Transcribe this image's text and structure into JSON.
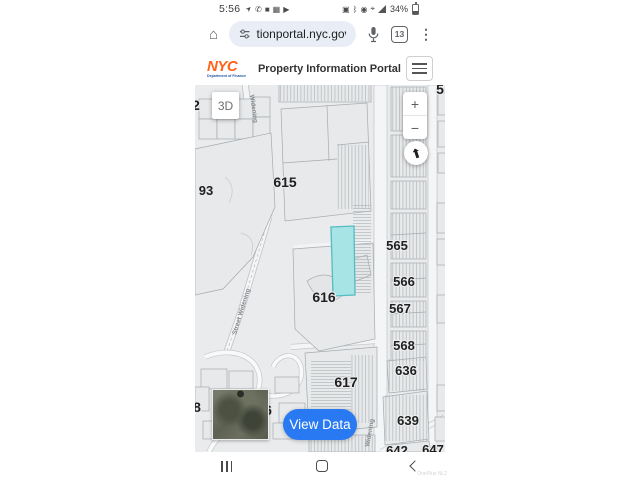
{
  "status_bar": {
    "time": "5:56",
    "battery_percent": "34%",
    "left_icons": [
      "navigation-icon",
      "whatsapp-icon",
      "app-icon",
      "app-icon-2",
      "youtube-icon"
    ],
    "right_icons": [
      "screenshot-icon",
      "bluetooth-icon",
      "location-icon",
      "vibrate-icon",
      "signal-icon",
      "battery-icon"
    ]
  },
  "browser": {
    "url": "tionportal.nyc.gov",
    "tab_count": "13",
    "menu_glyph": "⋮"
  },
  "header": {
    "logo_line1": "NYC",
    "logo_line2": "Department of Finance",
    "title": "Property Information Portal"
  },
  "map": {
    "controls": {
      "three_d": "3D",
      "zoom_in": "+",
      "zoom_out": "−",
      "view_data": "View Data"
    },
    "block_numbers": [
      "615",
      "616",
      "617",
      "565",
      "566",
      "567",
      "568",
      "636",
      "639",
      "93",
      "642",
      "647"
    ],
    "partial_numbers": [
      "2",
      "8",
      "6",
      "5"
    ],
    "street_labels": [
      "Widening",
      "Street Widening",
      "Widening"
    ],
    "colors": {
      "selected_lot_fill": "#a7e4e6",
      "selected_lot_stroke": "#54bcc2",
      "view_data_blue": "#2979f2",
      "map_background": "#e9ebec",
      "nyc_logo_orange": "#ff6319",
      "nyc_logo_blue": "#2456a4"
    }
  },
  "nav_bar": {
    "watermark": "OnePlus NL2"
  }
}
